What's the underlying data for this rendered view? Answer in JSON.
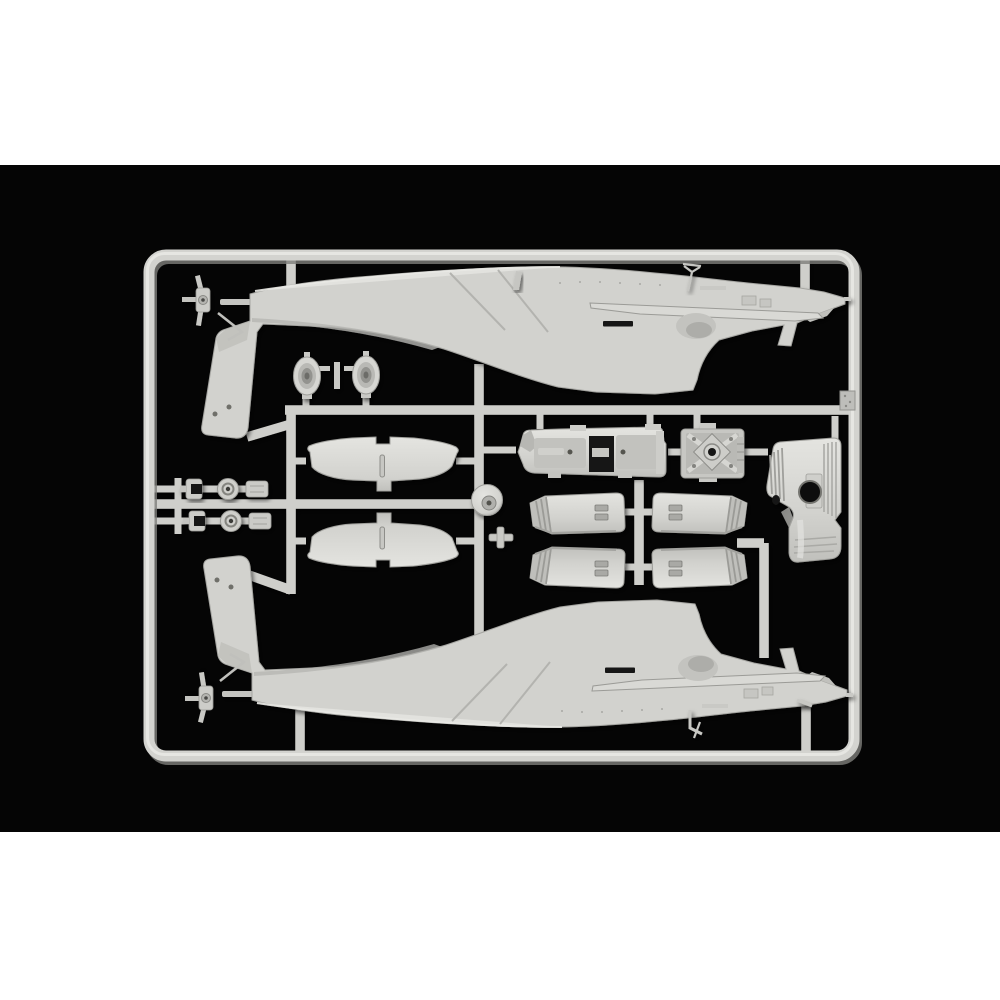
{
  "scene": {
    "type": "product-photo",
    "subject": "Injection-molded plastic model kit sprue (parts tree) in light grey styrene",
    "kit_subject": "AH-64 Apache attack helicopter kit sprue: two fuselage halves, stabilizer wing pairs, cockpit tub, gearbox, engine cowling panels, exhaust rings and small detail parts",
    "background": "black field with white bands above and below",
    "field_top": 165,
    "field_bottom": 832
  },
  "colors": {
    "page_bg": "#ffffff",
    "field_bg": "#050505",
    "plastic": "#d2d2ce",
    "plastic_light": "#e4e4e0",
    "plastic_mid": "#c0c0bc",
    "plastic_shade": "#9a9a96",
    "plastic_deep": "#7e7e7a",
    "detail_dark": "#141412",
    "frame": "#d3d3cf",
    "runner": "#cfcfcb"
  },
  "parts": [
    {
      "id": "sprue-frame",
      "label": "Rectangular sprue frame with runners"
    },
    {
      "id": "fuselage-top",
      "label": "Helicopter fuselage half (upper position, tail fin down-left, nose right)"
    },
    {
      "id": "fuselage-bottom",
      "label": "Helicopter fuselage half (lower position, mirrored, tail fin up-left)"
    },
    {
      "id": "tail-rotor-hub-top",
      "label": "Tail rotor hub (upper left)"
    },
    {
      "id": "tail-rotor-hub-bottom",
      "label": "Tail rotor hub (lower left)"
    },
    {
      "id": "exhaust-ring-left",
      "label": "Engine exhaust ring part (left)"
    },
    {
      "id": "exhaust-ring-right",
      "label": "Engine exhaust ring part (right)"
    },
    {
      "id": "wing-pair-upper",
      "label": "Horizontal stabilizer wing pair (upper)"
    },
    {
      "id": "wing-pair-lower",
      "label": "Horizontal stabilizer wing pair (lower)"
    },
    {
      "id": "small-parts-row-1",
      "label": "Small parts row: bracket, wheel hub, plate"
    },
    {
      "id": "small-parts-row-2",
      "label": "Small parts row: bracket, wheel hub, plate"
    },
    {
      "id": "cockpit-tub",
      "label": "Tandem cockpit tub with bays"
    },
    {
      "id": "gearbox",
      "label": "Main rotor gearbox housing with X-brace"
    },
    {
      "id": "nacelle-cover",
      "label": "Engine nacelle cover with louvers and round opening"
    },
    {
      "id": "cowl-panels",
      "label": "Four engine cowling panels (2 x 2) with ribbed ends"
    },
    {
      "id": "swashplate-disc",
      "label": "Rotor swashplate disc"
    },
    {
      "id": "cross-bracket",
      "label": "Small cross-shaped bracket"
    },
    {
      "id": "antennas",
      "label": "Small antenna and pitot parts"
    }
  ]
}
